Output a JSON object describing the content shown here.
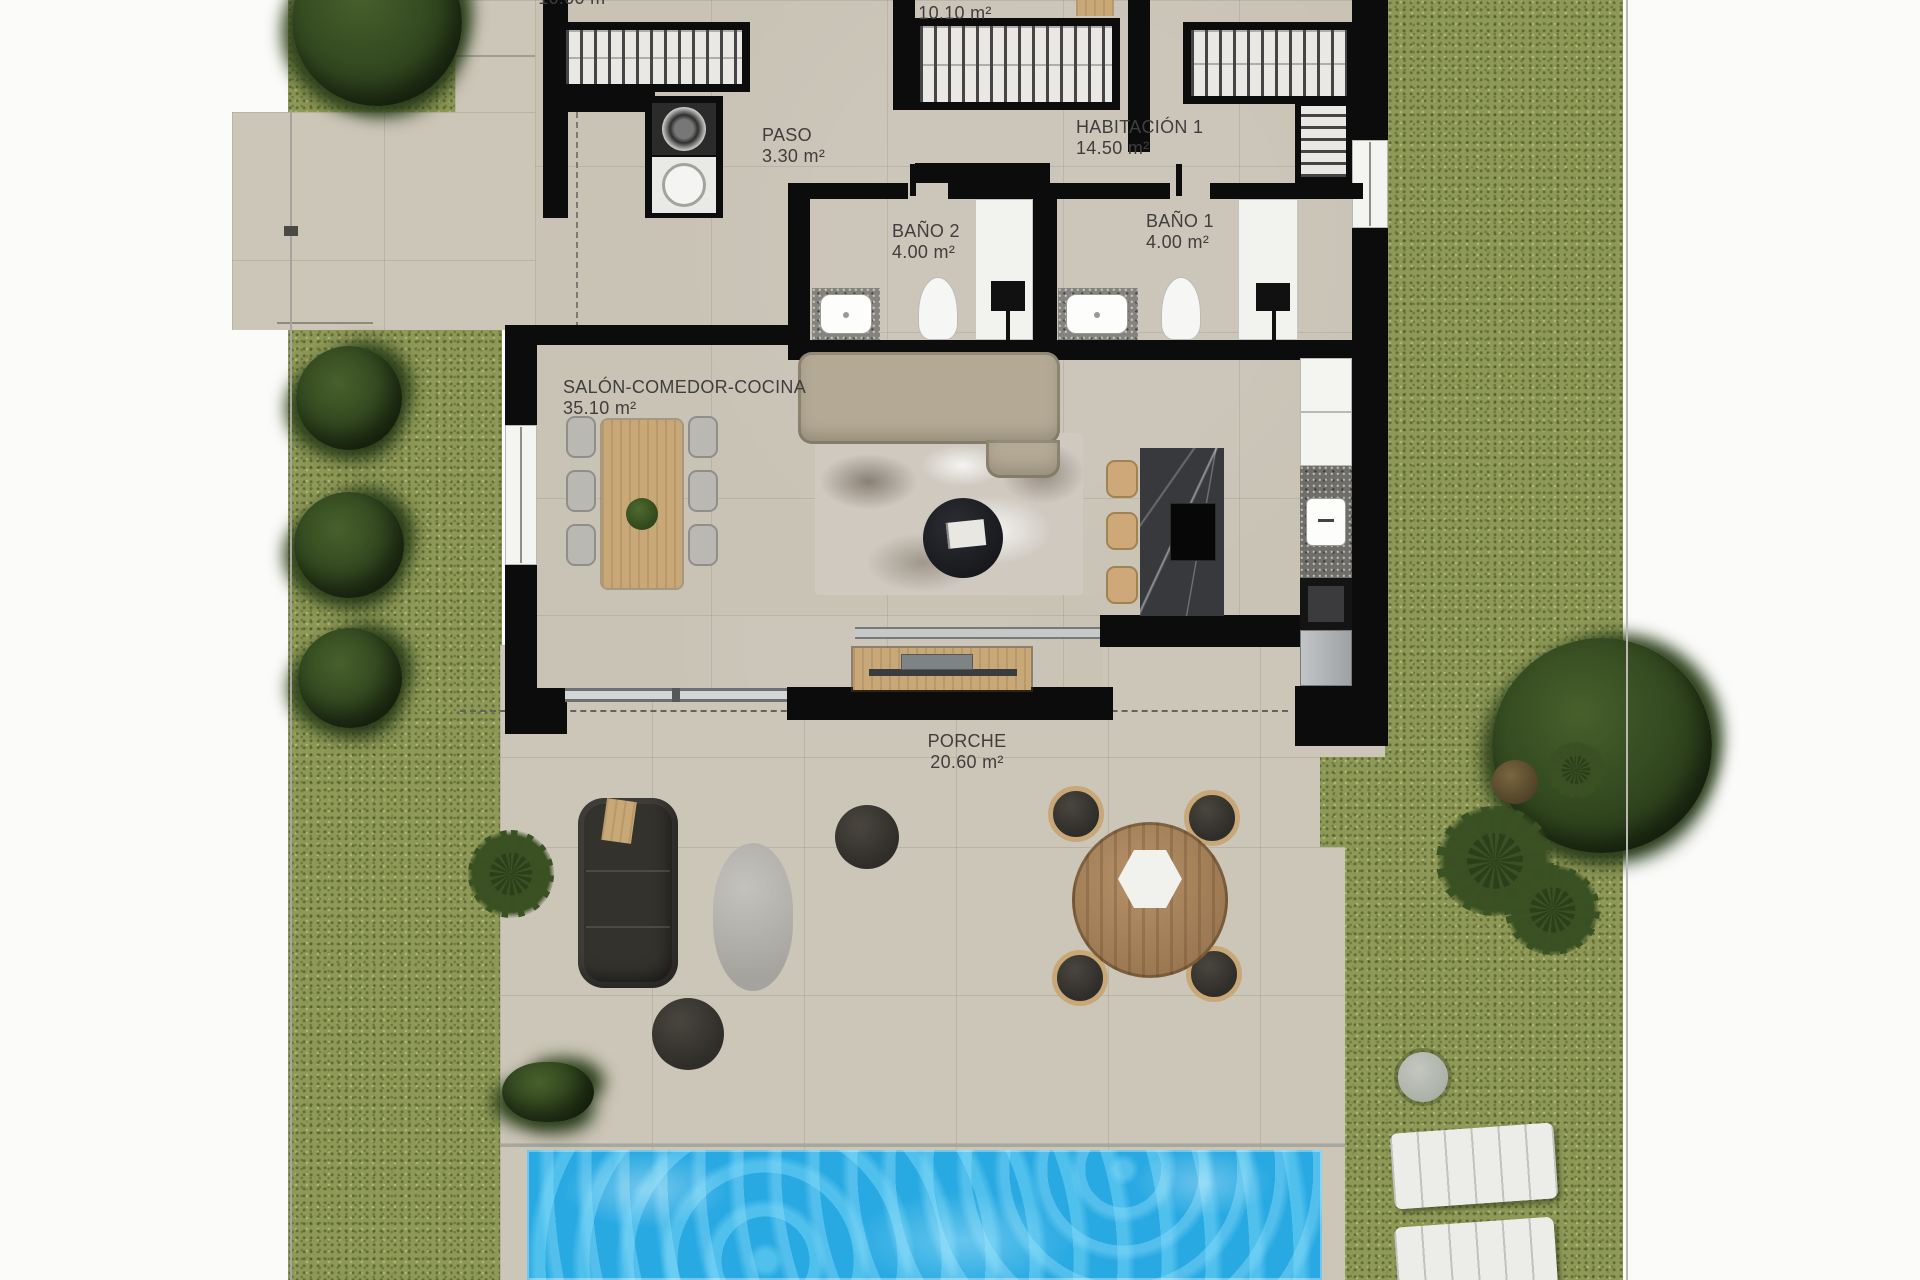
{
  "plan": {
    "rooms": {
      "bedroom2": {
        "area": "10.00 m²"
      },
      "bedroom3": {
        "area": "10.10 m²"
      },
      "paso": {
        "name": "PASO",
        "area": "3.30 m²"
      },
      "habitacion1": {
        "name": "HABITACIÓN 1",
        "area": "14.50 m²"
      },
      "bano2": {
        "name": "BAÑO 2",
        "area": "4.00 m²"
      },
      "bano1": {
        "name": "BAÑO 1",
        "area": "4.00 m²"
      },
      "salon": {
        "name": "SALÓN-COMEDOR-COCINA",
        "area": "35.10 m²"
      },
      "porche": {
        "name": "PORCHE",
        "area": "20.60 m²"
      }
    },
    "colors": {
      "wall": "#0c0c0c",
      "floor": "#c9c3b6",
      "deck": "#ccc6b8",
      "grass": "#8e9857",
      "pool_water": "#28a9e2",
      "wood": "#c9a878",
      "label_text": "#3f3e3c"
    }
  }
}
